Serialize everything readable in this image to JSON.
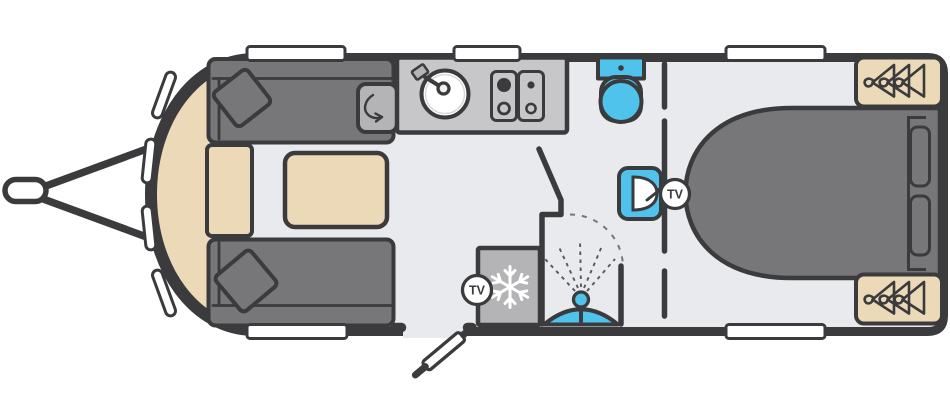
{
  "labels": {
    "tv_front": "TV",
    "tv_rear": "TV"
  },
  "palette": {
    "outline": "#3b3b3d",
    "floor": "#e8eaed",
    "upholstery_gray": "#77777a",
    "worktop_gray": "#c7c7c9",
    "appliance_gray": "#b4b4b6",
    "fixture_blue": "#4fc3ec",
    "wood_beige": "#ecd9b8",
    "window_white": "#ffffff"
  },
  "floorplan": {
    "vehicle_type": "touring-caravan",
    "orientation": "hitch-on-left",
    "areas": [
      {
        "name": "front-lounge",
        "items": [
          "front-shelf",
          "sofa-top",
          "sofa-bottom",
          "scatter-cushion-top",
          "scatter-cushion-bottom",
          "chest-seat",
          "table"
        ]
      },
      {
        "name": "kitchen",
        "items": [
          "worktop-flap",
          "worktop",
          "sink-with-tap",
          "hob-4-burner"
        ]
      },
      {
        "name": "washroom",
        "items": [
          "toilet",
          "washbasin",
          "shower-enclosure",
          "shower-head",
          "shower-tray"
        ]
      },
      {
        "name": "mid",
        "items": [
          "fridge-freezer",
          "entry-door"
        ]
      },
      {
        "name": "rear-bedroom",
        "items": [
          "island-bed",
          "bed-pillows",
          "wardrobe-top",
          "wardrobe-bottom"
        ]
      }
    ],
    "icons": [
      {
        "name": "snowflake-icon",
        "meaning": "fridge/freezer"
      },
      {
        "name": "hanging-clothes-icon",
        "meaning": "wardrobe"
      },
      {
        "name": "swing-arrow-icon",
        "meaning": "hinged worktop flap"
      },
      {
        "name": "tv-point-badge",
        "meaning": "TV connection point",
        "count": 2
      },
      {
        "name": "shower-spray-icon",
        "meaning": "shower"
      }
    ],
    "windows": {
      "top": 3,
      "bottom": 2,
      "front": 4
    }
  }
}
